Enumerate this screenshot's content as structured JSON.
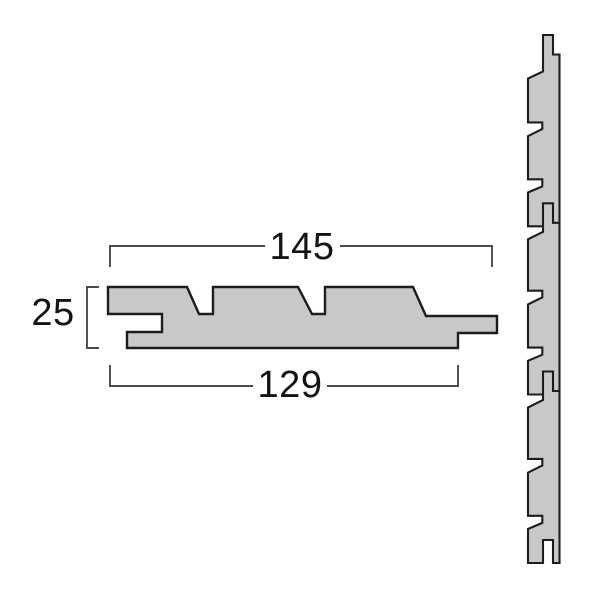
{
  "diagram": {
    "dimensions": {
      "overall_width": "145",
      "thickness": "25",
      "cover_width": "129"
    },
    "colors": {
      "background": "#ffffff",
      "board_fill": "#c8c8c8",
      "board_outline": "#1d1d1d",
      "dimension_line": "#4a4a4a",
      "dimension_text": "#141414"
    }
  }
}
